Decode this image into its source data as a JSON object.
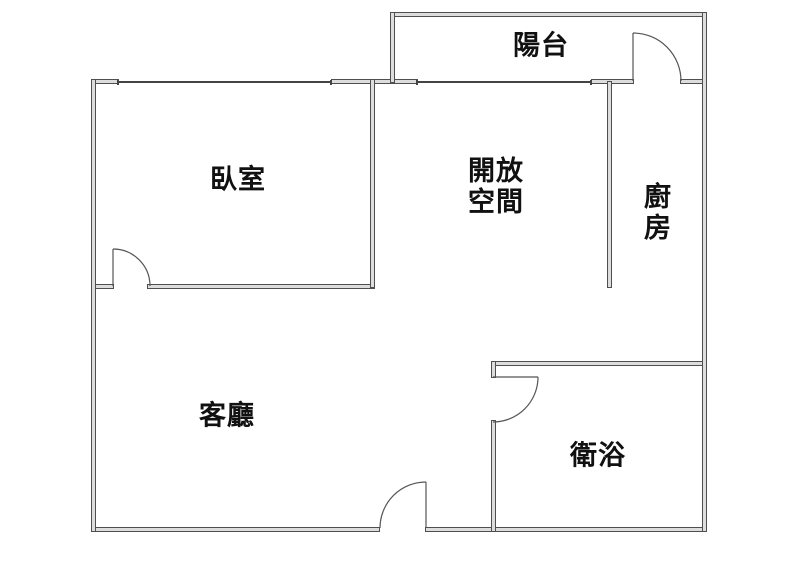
{
  "rooms": {
    "balcony": {
      "label": "陽台"
    },
    "bedroom": {
      "label": "臥室"
    },
    "open_space": {
      "label": "開放\n空間"
    },
    "kitchen": {
      "label": "廚\n房"
    },
    "living_room": {
      "label": "客廳"
    },
    "bathroom": {
      "label": "衛浴"
    }
  },
  "colors": {
    "background": "#ffffff",
    "wall_fill": "#dddddd",
    "wall_edge": "#4f4f4f",
    "door_line": "#555555",
    "text": "#111111"
  }
}
